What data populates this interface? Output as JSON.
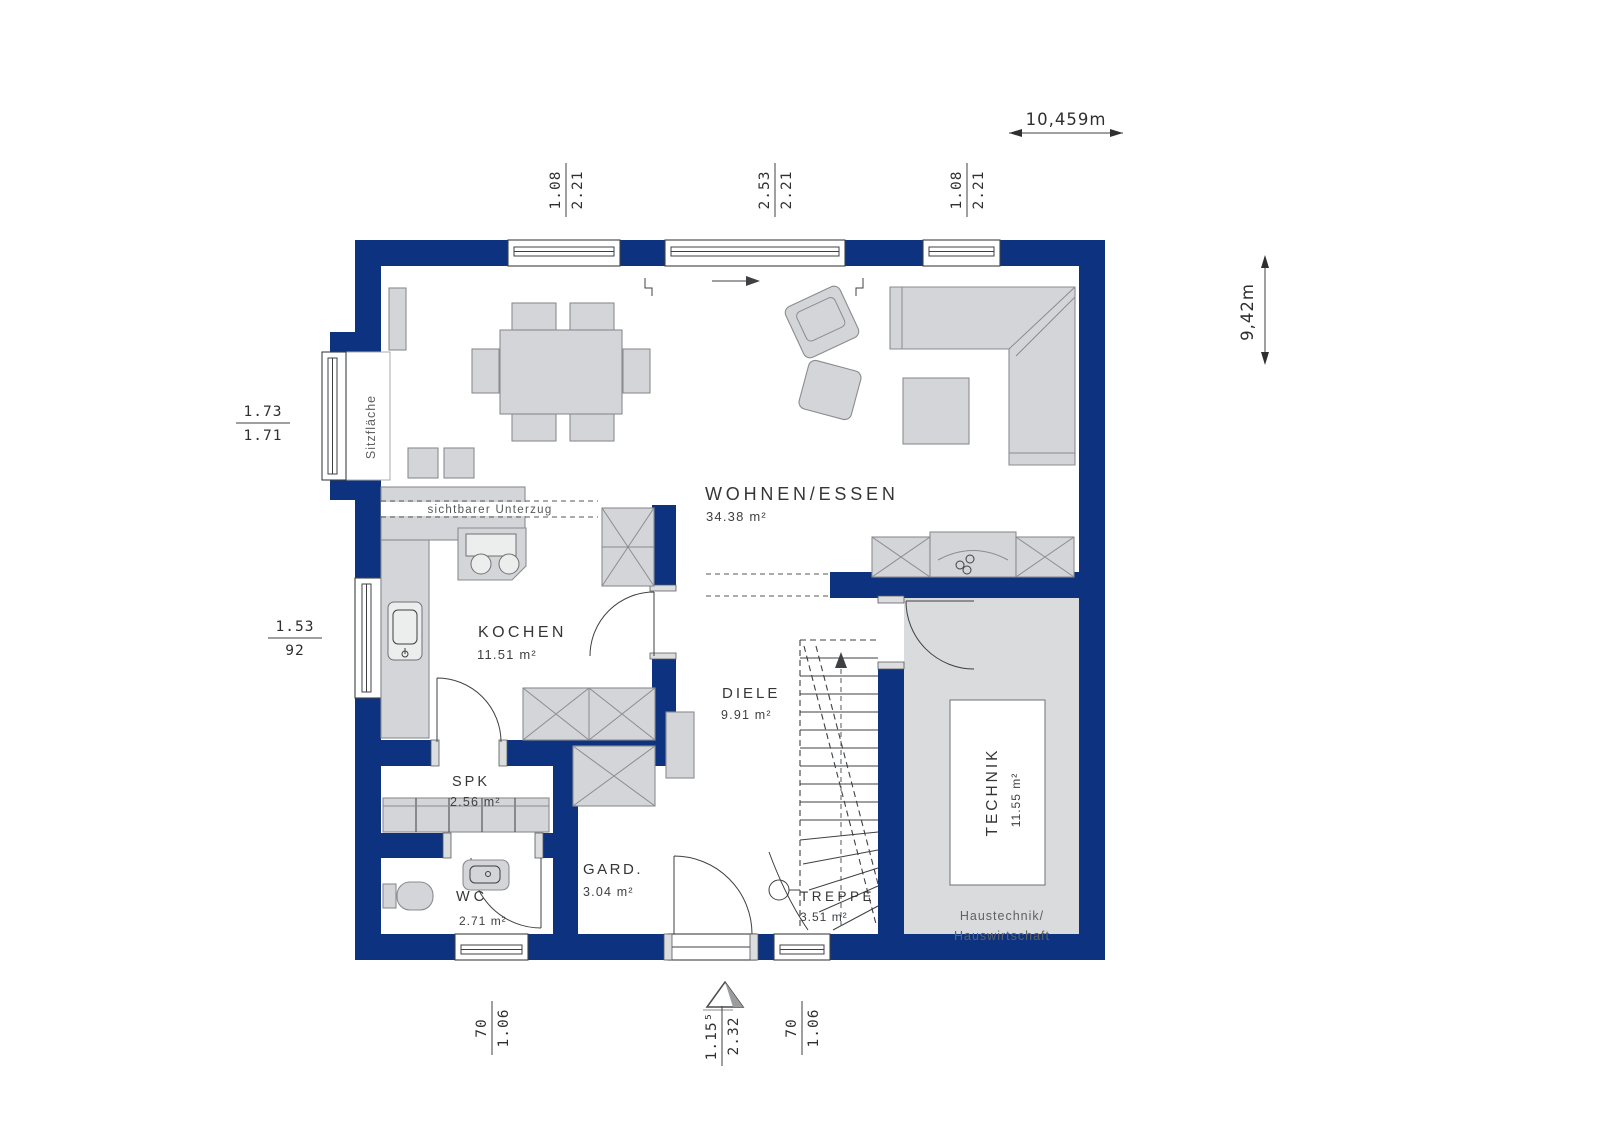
{
  "plan": {
    "rooms": [
      {
        "name": "WOHNEN/ESSEN",
        "area": "34.38 m²"
      },
      {
        "name": "KOCHEN",
        "area": "11.51 m²"
      },
      {
        "name": "DIELE",
        "area": "9.91 m²"
      },
      {
        "name": "SPK",
        "area": "2.56 m²"
      },
      {
        "name": "GARD.",
        "area": "3.04 m²"
      },
      {
        "name": "WC",
        "area": "2.71 m²"
      },
      {
        "name": "TREPPE",
        "area": "3.51 m²"
      },
      {
        "name": "TECHNIK",
        "area": "11.55 m²"
      }
    ],
    "annotations": {
      "window_seat": "Sitzfläche",
      "visible_beam": "sichtbarer Unterzug",
      "technik_note_1": "Haustechnik/",
      "technik_note_2": "Hauswirtschaft"
    },
    "dimensions": {
      "overall_width": "10,459m",
      "overall_height": "9,42m",
      "window_top_1": {
        "w": "1.08",
        "h": "2.21"
      },
      "window_top_2": {
        "w": "2.53",
        "h": "2.21"
      },
      "window_top_3": {
        "w": "1.08",
        "h": "2.21"
      },
      "window_left_1": {
        "w": "1.73",
        "h": "1.71"
      },
      "window_left_2": {
        "w": "1.53",
        "h": "92"
      },
      "window_bottom_1": {
        "w": "70",
        "h": "1.06"
      },
      "door_bottom": {
        "w": "1.15⁵",
        "h": "2.32"
      },
      "window_bottom_2": {
        "w": "70",
        "h": "1.06"
      }
    },
    "colors": {
      "wall": "#0d3380",
      "furniture": "#d3d5d8",
      "floor": "#d9dbdd"
    }
  }
}
